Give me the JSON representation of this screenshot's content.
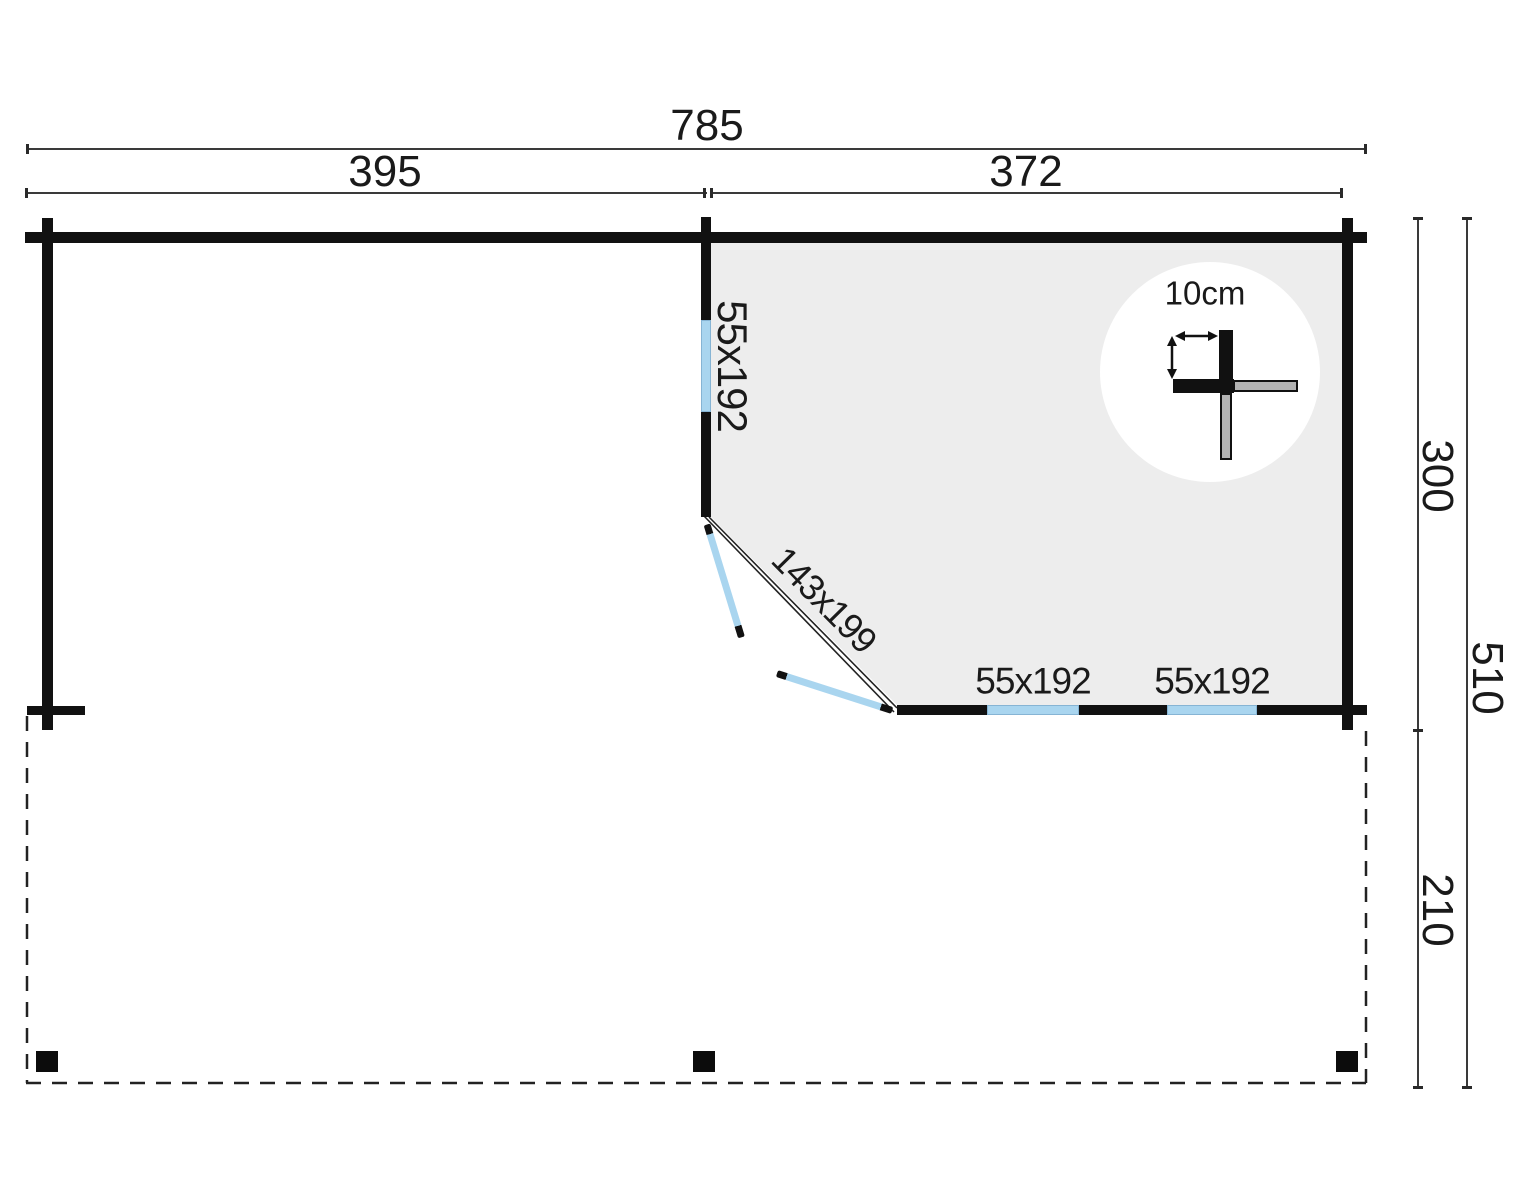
{
  "floorplan": {
    "dimensions": {
      "total_width": "785",
      "left_section_width": "395",
      "right_section_width": "372",
      "cabin_depth": "300",
      "total_depth": "510",
      "terrace_depth": "210"
    },
    "windows": {
      "side_window": "55x192",
      "front_window_1": "55x192",
      "front_window_2": "55x192"
    },
    "door": {
      "label": "143x199"
    },
    "wall_detail": {
      "thickness_label": "10cm"
    },
    "colors": {
      "wall": "#111111",
      "window_glass": "#a9d5ef",
      "room_floor": "#ededed",
      "detail_log_gray": "#b3b3b3"
    }
  }
}
